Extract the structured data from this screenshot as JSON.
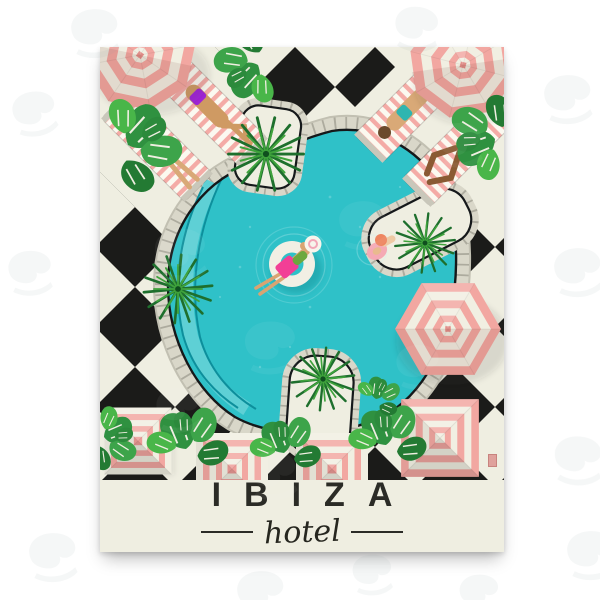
{
  "product": {
    "background_color": "#ffffff",
    "watermark_icon": "swirl-watermark"
  },
  "poster": {
    "title": "IBIZA",
    "subtitle": "hotel",
    "ink_color": "#2b2b26",
    "seal_color": "#dfa19c",
    "scene": {
      "description": "Top-down illustration of a hotel swimming pool on a black and cream checkerboard terrace with pink striped parasols, sun loungers, palm trees, monstera plants, a woman on a swim ring and a swimmer at the pool edge",
      "people_count": "6",
      "umbrella_count": "7",
      "palm_tree_count": "4",
      "sun_lounger_count": "4",
      "colors": {
        "canvas_cream": "#efeee1",
        "checker_black": "#1b1b19",
        "pool_water": "#2fc1c8",
        "pool_water_light": "#5ed0d5",
        "pool_water_dark": "#0d8f9c",
        "deck_gray": "#d9d7c9",
        "deck_tick": "#a5a396",
        "umbrella_pink": "#f2a7a1",
        "umbrella_cream": "#f1efe2",
        "lounger_stripe_pink": "#f4aba6",
        "palm_green": "#1e6f2d",
        "monstera_green": "#2f9140",
        "skin_tan": "#d9a472",
        "skin_dark": "#8a5a33",
        "suit_teal": "#2fb5b0",
        "suit_purple": "#a224d8",
        "suit_magenta": "#f23f96",
        "suit_yellow": "#f0cb45",
        "swim_cap_coral": "#ee8560",
        "float_ring_cream": "#f2efe4"
      }
    }
  }
}
